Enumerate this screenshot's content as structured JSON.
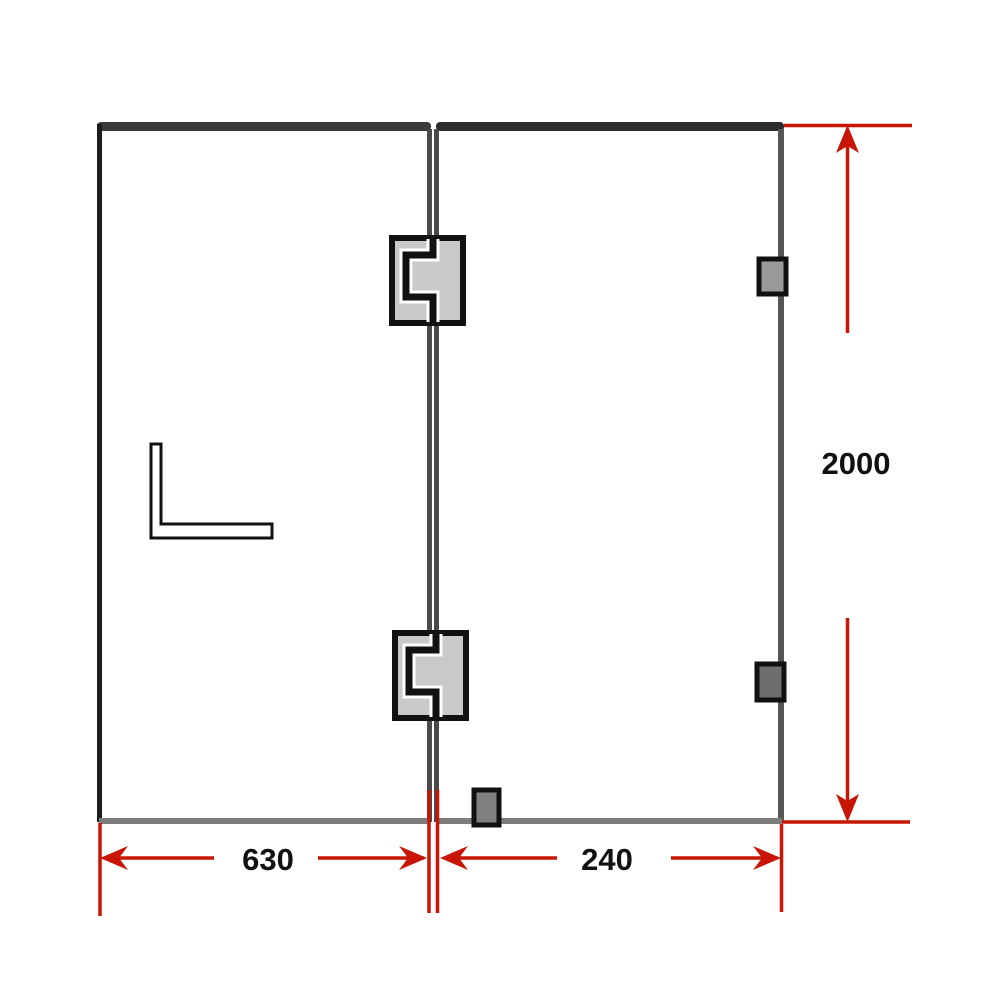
{
  "diagram": {
    "dimensions": {
      "height": "2000",
      "left_panel_width": "630",
      "right_panel_width": "240"
    },
    "colors": {
      "dimension_red": "#c81505",
      "frame_dark": "#3a3a3a",
      "frame_darker": "#2d2d2d",
      "frame_black": "#1d1d1d",
      "edge_gray": "#565656",
      "divider_gray": "#4a4a4a",
      "bottom_gray": "#7d7d7d",
      "hinge_fill": "#c9c9c9",
      "outline_black": "#111111",
      "clip_light": "#9a9a9a",
      "clip_dark": "#6e6e6e",
      "clip_mid": "#808080",
      "label_black": "#111111"
    }
  }
}
